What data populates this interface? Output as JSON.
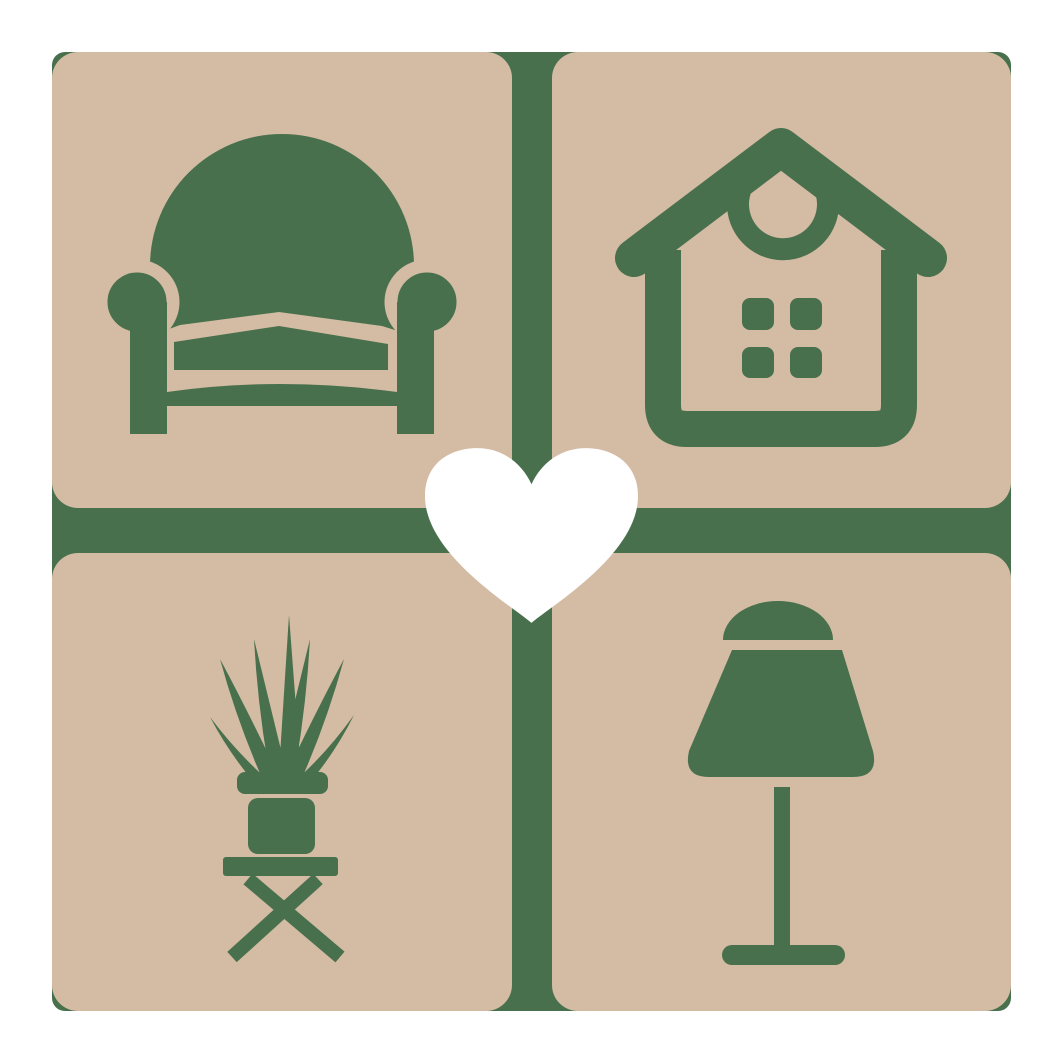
{
  "type": "logo-graphic",
  "title": "Home and furniture love logo",
  "colors": {
    "page_bg": "#ffffff",
    "backing": "#48704c",
    "tile": "#d3bba4",
    "icon": "#48704c",
    "heart": "#ffffff"
  },
  "layout": {
    "grid": "2x2 rounded tiles on green backing square",
    "gap_px": 42,
    "backing_bounds": "52,52 to 1011,1011"
  },
  "tiles": [
    {
      "position": "top-left",
      "icon": "armchair-icon",
      "label": "armchair"
    },
    {
      "position": "top-right",
      "icon": "house-icon",
      "label": "house with wreath and four-pane window"
    },
    {
      "position": "bottom-left",
      "icon": "potted-plant-icon",
      "label": "spiky potted plant on cross-leg table"
    },
    {
      "position": "bottom-right",
      "icon": "table-lamp-icon",
      "label": "table lamp"
    }
  ],
  "center_icon": {
    "icon": "heart-icon",
    "label": "white heart"
  }
}
